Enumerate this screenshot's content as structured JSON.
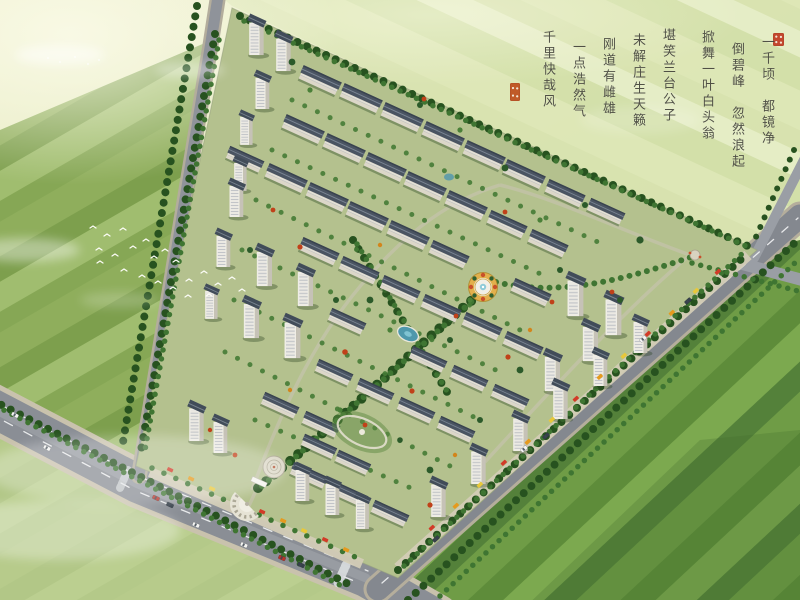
{
  "scene": {
    "description": "aerial rendering of a residential community surrounded by farmland and roads",
    "calligraphy": {
      "columns": [
        "一千顷　都镜净",
        "倒碧峰　忽然浪起",
        "掀舞一叶白头翁",
        "堪笑兰台公子",
        "未解庄生天籁",
        "刚道有雌雄",
        "一点浩然气",
        "千里快哉风"
      ]
    },
    "palette": {
      "field_pale": "#e9ecc6",
      "field_green": "#8fae5c",
      "field_dark": "#5e8c3a",
      "road_grey": "#8a8e95",
      "roof_slate": "#4a5462",
      "wall_white": "#efede6",
      "tree_green": "#2c5a2a",
      "accent_tree_red": "#c04119",
      "water_teal": "#4e98ac",
      "plaza_gold": "#e2b04c",
      "seal_red": "#c3472e"
    }
  }
}
